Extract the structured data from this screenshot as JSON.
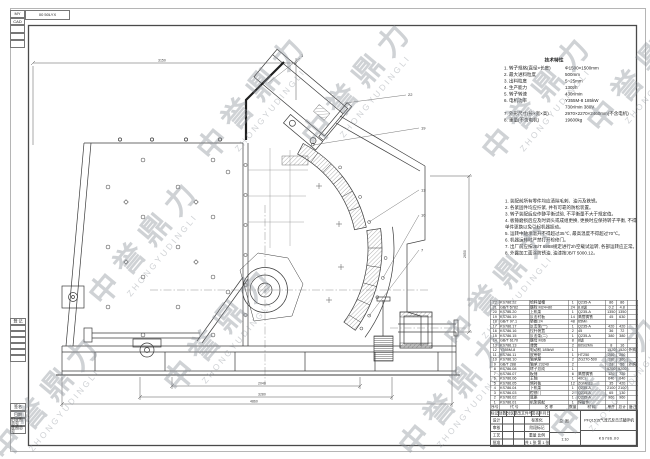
{
  "watermark": {
    "cn": "中誉鼎力",
    "en": "ZHONGYUDINGLI"
  },
  "corner_block": {
    "col_rows": [
      "MY",
      "CAD",
      "",
      "",
      ""
    ],
    "code": "00 50LYX"
  },
  "binding_strip": {
    "register_label": "登 记",
    "labels": [
      "签名",
      "日期",
      "旧底图总号",
      "底图总号"
    ]
  },
  "specs": {
    "title": "技术特性",
    "items": [
      {
        "label": "1. 转子规格(直径×长度)",
        "value": "Φ1500×1500mm"
      },
      {
        "label": "2. 最大进料粒度",
        "value": "500mm"
      },
      {
        "label": "3. 出料粒度",
        "value": "5~25mm"
      },
      {
        "label": "4. 生产能力",
        "value": "130t/h"
      },
      {
        "label": "5. 转子转速",
        "value": "430r/min"
      },
      {
        "label": "6. 电机功率",
        "value": "Y355M-8  185kW"
      },
      {
        "label": "7. 外形尺寸(长×宽×高)",
        "value": "2970×2270×2460mm(不含电机)"
      },
      {
        "label": "8. 重量(不含电机)",
        "value": "19600kg"
      }
    ],
    "sub_value": "730r/min  380V"
  },
  "notes": {
    "lines": [
      "1. 装配前所有零件均应清除毛刺、油污及铁锈。",
      "2. 各紧固件均应拧紧, 并有可靠的防松装置。",
      "3. 转子装配后应作静平衡试验, 不平衡量不大于规定值。",
      "4. 板锤磨损后应及时调头或成组更换, 更换时应保持转子平衡, 不得单件更换以免引起机器振动。",
      "5. 运转中轴承温升不得超过35℃, 最高温度不得超过70℃。",
      "6. 机器运转时严禁打开检修门。",
      "7. 出厂前应按JB/T 6988规定进行2h空载试运转, 各部运转应正常。",
      "8. 外露加工面涂防锈油, 油漆按JB/T 5000.12。"
    ]
  },
  "parts_table": {
    "headers": [
      "序号",
      "代  号",
      "名  称",
      "数量",
      "材  料",
      "单件",
      "总计",
      "备注"
    ],
    "rows": [
      [
        "22",
        "KS786.22",
        "给料溜槽",
        "1",
        "Q235-A",
        "86",
        "86",
        ""
      ],
      [
        "21",
        "GB/T 5782",
        "螺栓 M24×80",
        "24",
        "8.8级",
        "0.2",
        "4.8",
        ""
      ],
      [
        "20",
        "KS786.20",
        "上机架",
        "1",
        "Q235-A",
        "1350",
        "1350",
        ""
      ],
      [
        "19",
        "KS786.19",
        "反击衬板",
        "14",
        "高铬铸铁",
        "45",
        "630",
        ""
      ],
      [
        "18",
        "GB/T 97.1",
        "垫圈 24",
        "48",
        "65Mn",
        "",
        "",
        ""
      ],
      [
        "17",
        "KS786.17",
        "反击架(一)",
        "1",
        "Q235-A",
        "420",
        "420",
        ""
      ],
      [
        "16",
        "KS786.16",
        "拉杆装置",
        "2",
        "45",
        "36",
        "72",
        ""
      ],
      [
        "15",
        "KS786.15",
        "反击架(二)",
        "1",
        "Q235-A",
        "380",
        "380",
        ""
      ],
      [
        "14",
        "GB/T 6170",
        "螺母 M36",
        "8",
        "8级",
        "",
        "",
        ""
      ],
      [
        "13",
        "KS786.13",
        "弹簧",
        "2",
        "60Si2Mn",
        "8",
        "16",
        ""
      ],
      [
        "12",
        "Y355M-8",
        "电动机 185kW",
        "1",
        "",
        "1520",
        "1520",
        "外购"
      ],
      [
        "11",
        "KS786.11",
        "皮带轮",
        "1",
        "HT250",
        "260",
        "260",
        ""
      ],
      [
        "10",
        "KS786.10",
        "轴承座",
        "2",
        "ZG270-500",
        "180",
        "360",
        ""
      ],
      [
        "9",
        "GB/T 288",
        "轴承 23240",
        "2",
        "",
        "28",
        "56",
        "外购"
      ],
      [
        "8",
        "KS786.08",
        "转子总成",
        "1",
        "",
        "5200",
        "5200",
        ""
      ],
      [
        "7",
        "KS786.07",
        "板锤",
        "6",
        "高铬铸铁",
        "120",
        "720",
        ""
      ],
      [
        "6",
        "KS786.06",
        "主轴",
        "1",
        "40Cr",
        "640",
        "640",
        ""
      ],
      [
        "5",
        "KS786.05",
        "侧衬板",
        "12",
        "ZGMn13",
        "35",
        "420",
        ""
      ],
      [
        "4",
        "KS786.04",
        "下机架",
        "1",
        "Q235-A",
        "2100",
        "2100",
        ""
      ],
      [
        "3",
        "KS786.03",
        "检修门",
        "2",
        "Q235-A",
        "65",
        "130",
        ""
      ],
      [
        "2",
        "KS786.02",
        "底座",
        "1",
        "Q235-A",
        "960",
        "960",
        ""
      ],
      [
        "1",
        "KS786.01",
        "机架装配",
        "1",
        "焊接件",
        "",
        "",
        ""
      ]
    ]
  },
  "title_block": {
    "rev_headers": [
      "标记",
      "处数",
      "分区",
      "更改文件号",
      "签名",
      "年月日"
    ],
    "sign_labels": [
      "设计",
      "审核",
      "工艺",
      "批准"
    ],
    "aux_labels": [
      "标准化",
      "阶段标记",
      "重量  比例",
      "共 1 张  第 1 张"
    ],
    "scale_value": "1:10",
    "view_label": "总图",
    "product_name": "PFQ1515气流式反击式破碎机",
    "drawing_no": "KS786.00"
  },
  "callouts": [
    "1",
    "22",
    "19",
    "13",
    "10",
    "7"
  ],
  "dims": {
    "top": "3150",
    "right": "2650",
    "b_inner": "2040",
    "b_mid": "3280",
    "b_outer": "4860"
  }
}
